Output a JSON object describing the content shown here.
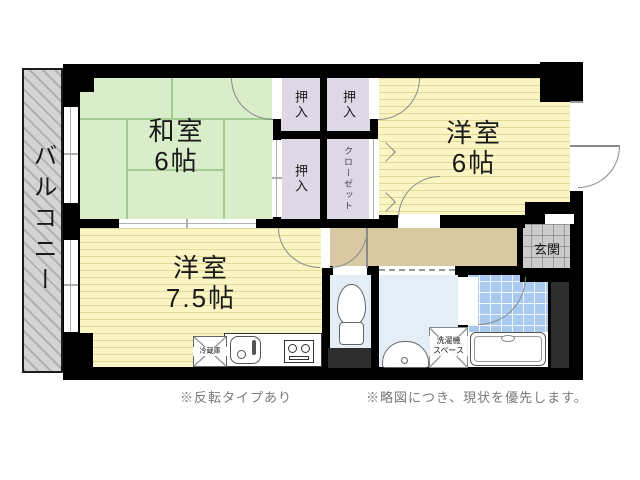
{
  "floorplan": {
    "balcony": {
      "label": "バルコニー"
    },
    "rooms": {
      "washitsu": {
        "name": "和室",
        "size": "6帖"
      },
      "western_6": {
        "name": "洋室",
        "size": "6帖"
      },
      "western_75": {
        "name": "洋室",
        "size": "7.5帖"
      }
    },
    "storage": {
      "oshiire_top_left": "押入",
      "oshiire_top_right": "押入",
      "oshiire_bottom_left": "押入",
      "closet": "クローゼット"
    },
    "entrance": {
      "label": "玄関"
    },
    "kitchen": {
      "fridge_label": "冷蔵庫"
    },
    "laundry": {
      "line1": "洗濯機",
      "line2": "スペース"
    },
    "notes": {
      "left": "※反転タイプあり",
      "right": "※略図につき、現状を優先します。"
    },
    "colors": {
      "wall": "#000000",
      "shaft": "#2e2e2e",
      "tatami": "#d9edca",
      "flooring": "#fbf5c4",
      "closet": "#ded8e6",
      "hallway": "#d8c9a3",
      "wet_area": "#e4eef7",
      "bath_tile": "#a9c9ee",
      "entrance_tile": "#cccccc",
      "balcony": "#d4d4d4"
    }
  }
}
